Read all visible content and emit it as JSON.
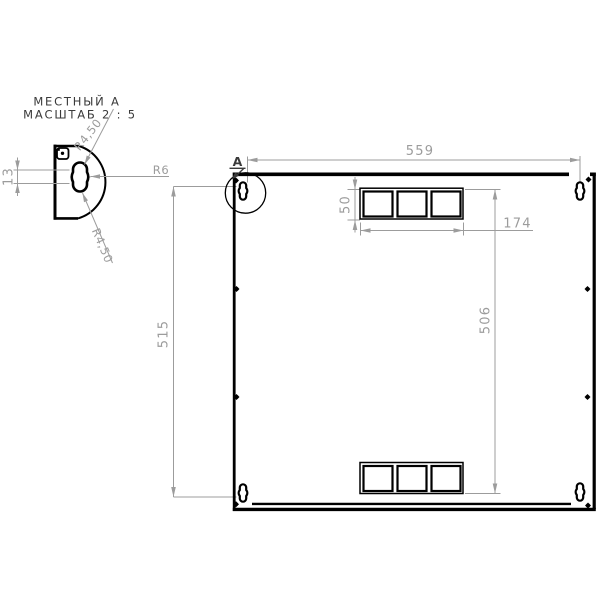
{
  "drawing": {
    "detail_view": {
      "title": "МЕСТНЫЙ А",
      "scale_label": "МАСШТАБ 2 : 5",
      "dim_slot_length": "13",
      "dim_radius_top": "R4,50",
      "dim_radius_bottom": "R4,50",
      "dim_radius_center": "R6"
    },
    "main_view": {
      "detail_callout": "A",
      "dim_width": "559",
      "dim_height": "515",
      "dim_cutout_span": "506",
      "dim_cutout_height": "50",
      "dim_cutout_width": "174"
    },
    "colors": {
      "outline": "#000000",
      "dimension": "#9c9c9c",
      "label": "#3a3a3a",
      "background": "#ffffff"
    }
  }
}
